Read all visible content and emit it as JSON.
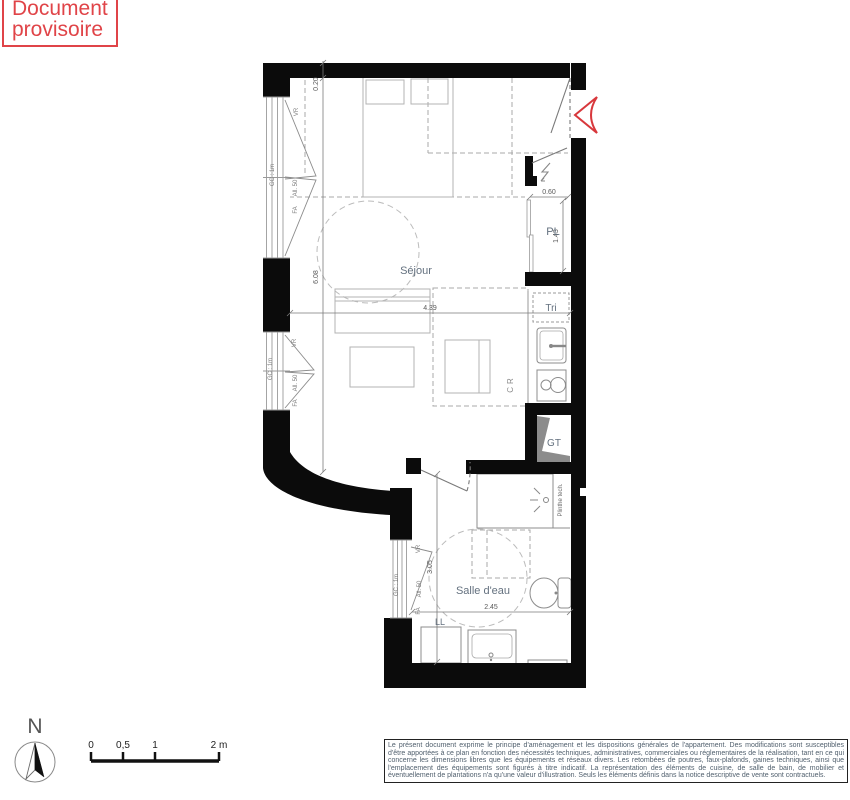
{
  "stamp": {
    "line1": "Document",
    "line2": "provisoire"
  },
  "plan": {
    "rooms": {
      "sejour": "Séjour",
      "salle_deau": "Salle d'eau",
      "placard": "PL",
      "gaine_technique": "GT",
      "tri": "Tri",
      "lave_linge": "LL",
      "cuisine_refrigerateur": "CR",
      "plinthe_technique": "Plinthe tech."
    },
    "dimensions": {
      "wall_offset": "0.20",
      "sejour_depth": "6.08",
      "sejour_width": "4.39",
      "placard_width": "0.60",
      "placard_depth": "1.43",
      "salle_deau_depth": "3.05",
      "salle_deau_width": "2.45"
    },
    "window_labels": {
      "volet_roulant": "VR",
      "garde_corps": "GC : 1m",
      "fenetre": "FA",
      "allege": "All. 50"
    },
    "colors": {
      "accent_red": "#e04448",
      "wall_black": "#0b0b0b",
      "label_blue_grey": "#64717f"
    }
  },
  "compass": {
    "north": "N"
  },
  "scale_bar": {
    "tick_0": "0",
    "tick_05": "0,5",
    "tick_1": "1",
    "tick_2": "2 m"
  },
  "disclaimer": {
    "text": "Le présent document exprime le principe d'aménagement et les dispositions générales de l'appartement. Des modifications sont susceptibles d'être apportées à ce plan en fonction des nécessités techniques, administratives, commerciales ou réglementaires de la réalisation, tant en ce qui concerne les dimensions libres que les équipements et réseaux divers. Les retombées de poutres, faux-plafonds, gaines techniques, ainsi que l'emplacement des équipements sont figurés à titre indicatif. La représentation des éléments de cuisine, de salle de bain, de mobilier et éventuellement de plantations n'a qu'une valeur d'illustration. Seuls les éléments définis dans la notice descriptive de vente sont contractuels."
  }
}
